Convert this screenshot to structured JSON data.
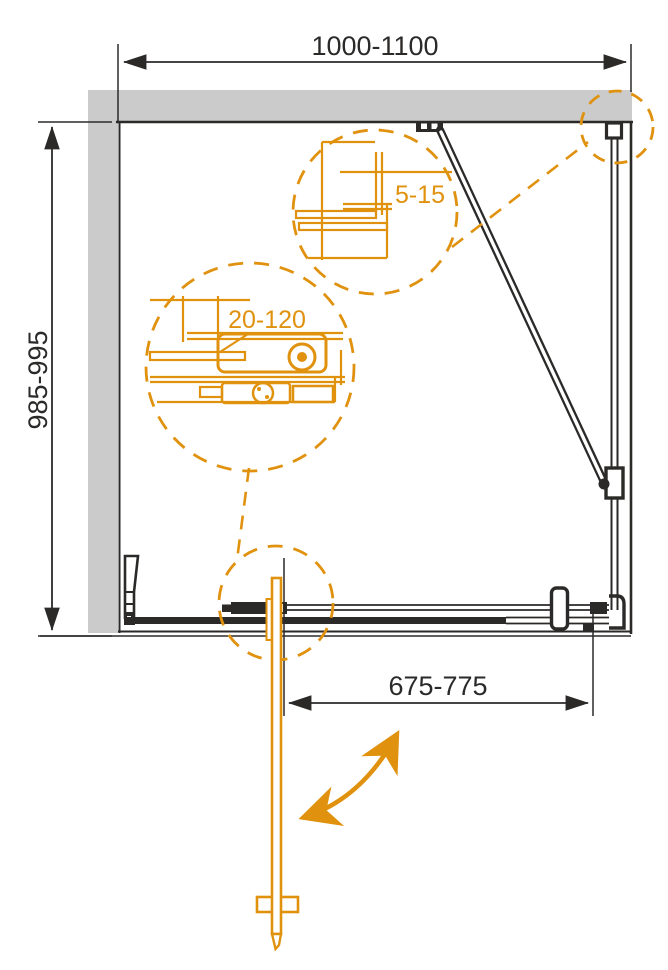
{
  "drawing": {
    "type": "shower-enclosure-plan-technical-drawing",
    "labels": {
      "width_range": "1000-1100",
      "height_range": "985-995",
      "door_opening_range": "675-775",
      "wall_profile_adjustment_range": "5-15",
      "roller_adjustment_range": "20-120"
    },
    "colors": {
      "line": "#2B2A29",
      "accent_orange": "#E0920F",
      "wall_gray": "#CBCBCB",
      "background": "#FFFFFF"
    }
  }
}
